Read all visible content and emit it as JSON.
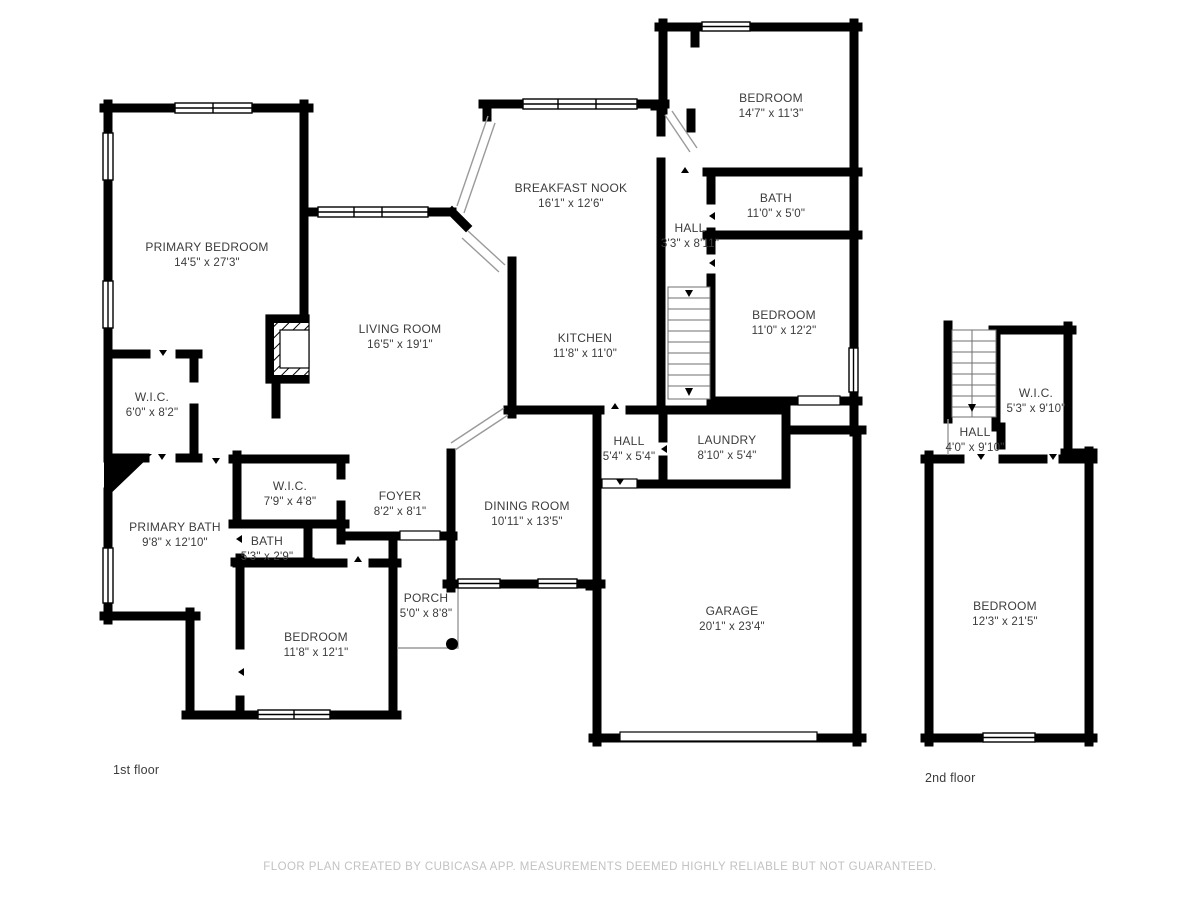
{
  "document": {
    "type": "floor-plan",
    "footer": "FLOOR PLAN CREATED BY CUBICASA APP. MEASUREMENTS DEEMED HIGHLY RELIABLE BUT NOT GUARANTEED."
  },
  "colors": {
    "wall": "#000000",
    "label_text": "#3c3c3c",
    "footer_text": "#c2c2c2",
    "thin_line": "#9a9a9a",
    "background": "#ffffff"
  },
  "floors": [
    {
      "label": "1st floor"
    },
    {
      "label": "2nd floor"
    }
  ],
  "rooms": [
    {
      "name": "PRIMARY BEDROOM",
      "dims": "14'5\" x 27'3\""
    },
    {
      "name": "BREAKFAST NOOK",
      "dims": "16'1\" x 12'6\""
    },
    {
      "name": "BEDROOM",
      "dims": "14'7\" x 11'3\""
    },
    {
      "name": "BATH",
      "dims": "11'0\" x 5'0\""
    },
    {
      "name": "HALL",
      "dims": "3'3\" x 8'11\""
    },
    {
      "name": "LIVING ROOM",
      "dims": "16'5\" x 19'1\""
    },
    {
      "name": "KITCHEN",
      "dims": "11'8\" x 11'0\""
    },
    {
      "name": "BEDROOM",
      "dims": "11'0\" x 12'2\""
    },
    {
      "name": "W.I.C.",
      "dims": "6'0\" x 8'2\""
    },
    {
      "name": "W.I.C.",
      "dims": "7'9\" x 4'8\""
    },
    {
      "name": "PRIMARY BATH",
      "dims": "9'8\" x 12'10\""
    },
    {
      "name": "BATH",
      "dims": "5'3\" x 2'9\""
    },
    {
      "name": "FOYER",
      "dims": "8'2\" x 8'1\""
    },
    {
      "name": "DINING ROOM",
      "dims": "10'11\" x 13'5\""
    },
    {
      "name": "HALL",
      "dims": "5'4\" x 5'4\""
    },
    {
      "name": "LAUNDRY",
      "dims": "8'10\" x 5'4\""
    },
    {
      "name": "PORCH",
      "dims": "5'0\" x 8'8\""
    },
    {
      "name": "BEDROOM",
      "dims": "11'8\" x 12'1\""
    },
    {
      "name": "GARAGE",
      "dims": "20'1\" x 23'4\""
    },
    {
      "name": "W.I.C.",
      "dims": "5'3\" x 9'10\""
    },
    {
      "name": "HALL",
      "dims": "4'0\" x 9'10\""
    },
    {
      "name": "BEDROOM",
      "dims": "12'3\" x 21'5\""
    }
  ]
}
